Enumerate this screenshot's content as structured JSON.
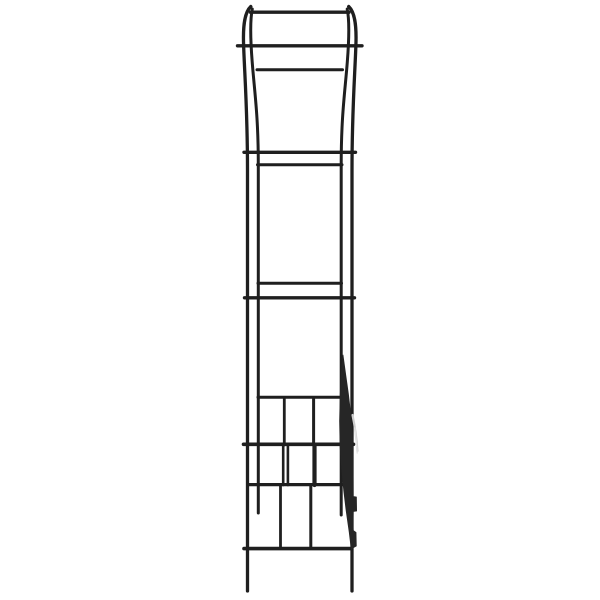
{
  "figure": {
    "alt": "Black metal garden arch trellis, side view, on white background",
    "background": "#ffffff",
    "metal_color": "#1f1f1f",
    "canvas": {
      "width": 600,
      "height": 600
    },
    "tubes": [
      {
        "name": "left-outer-tube",
        "d": "M 250.8,6.5 C 245,12 242.8,24 243.6,45 C 244.6,75 247.5,110 247.5,170 L 247.5,591",
        "w": 3.3
      },
      {
        "name": "left-inner-tube",
        "d": "M 252.3,9 C 250,20 250.3,38 252.2,62 C 254.5,92 258.3,115 258.3,165 L 258.3,513",
        "w": 3.0
      },
      {
        "name": "right-outer-tube",
        "d": "M 348.7,6.5 C 354.5,12 356.7,24 355.9,45 C 354.9,75 352,110 352,170 L 352,591",
        "w": 3.3
      },
      {
        "name": "right-inner-tube",
        "d": "M 347.2,9 C 349.5,20 349.2,38 347.3,62 C 345,92 341.2,115 341.2,165 L 341.2,515",
        "w": 3.0
      }
    ],
    "crossbars": [
      {
        "name": "top-arch-bar",
        "y": 12.2,
        "x1": 250.5,
        "x2": 349.0,
        "w": 3.4
      },
      {
        "name": "crossbar-2",
        "y": 45.8,
        "x1": 237.5,
        "x2": 362.0,
        "w": 3.4
      },
      {
        "name": "crossbar-3",
        "y": 69.8,
        "x1": 257.0,
        "x2": 342.5,
        "w": 3.0
      },
      {
        "name": "crossbar-4",
        "y": 152.3,
        "x1": 244.0,
        "x2": 355.5,
        "w": 3.4
      },
      {
        "name": "crossbar-5",
        "y": 164.8,
        "x1": 257.5,
        "x2": 342.0,
        "w": 3.0
      },
      {
        "name": "crossbar-6",
        "y": 283.2,
        "x1": 258.0,
        "x2": 341.5,
        "w": 3.0
      },
      {
        "name": "crossbar-7",
        "y": 297.8,
        "x1": 244.5,
        "x2": 354.5,
        "w": 3.4
      },
      {
        "name": "crossbar-8",
        "y": 397.3,
        "x1": 258.0,
        "x2": 342.5,
        "w": 3.0
      },
      {
        "name": "crossbar-9",
        "y": 444.3,
        "x1": 243.5,
        "x2": 353.5,
        "w": 3.6
      },
      {
        "name": "crossbar-10",
        "y": 484.6,
        "x1": 249.0,
        "x2": 345.0,
        "w": 3.2
      },
      {
        "name": "bottom-crossbar",
        "y": 548.6,
        "x1": 244.0,
        "x2": 351.5,
        "w": 3.6
      }
    ],
    "lattice_rods": [
      {
        "name": "lattice-rod-1",
        "x": 284.3,
        "y1": 399,
        "y2": 445,
        "w": 2.8
      },
      {
        "name": "lattice-rod-2",
        "x": 313.6,
        "y1": 399,
        "y2": 445,
        "w": 3.0
      },
      {
        "name": "lattice-rod-3",
        "x": 283.2,
        "y1": 445,
        "y2": 485,
        "w": 2.6
      },
      {
        "name": "lattice-rod-4",
        "x": 287.9,
        "y1": 445,
        "y2": 485,
        "w": 2.6
      },
      {
        "name": "lattice-rod-5",
        "x": 314.5,
        "y1": 445,
        "y2": 485,
        "w": 4.2
      },
      {
        "name": "lattice-rod-6",
        "x": 280.5,
        "y1": 485,
        "y2": 547,
        "w": 2.8
      },
      {
        "name": "lattice-rod-7",
        "x": 310.8,
        "y1": 485,
        "y2": 547,
        "w": 3.0
      }
    ],
    "trellis_blade": {
      "fill": "#262626",
      "points": "343,355 345.6,374 348.4,394 350.7,414 352.2,434 352.9,454 353.1,476 353.2,496.5 356.4,497 356.6,511 353.2,511.5 353,524 353.2,530.5 356,532.5 356.3,546 352.6,548 351.3,549.5 349.2,532 346.2,511 343.8,491 341.6,468 340.1,446 339.6,421 340.2,396 341.3,373"
    },
    "highlights": [
      {
        "name": "blade-highlight-1",
        "d": "M 352.5,415 C 354.6,425 356.6,438 357.4,451",
        "w": 2.2,
        "color": "#cfcfcf"
      },
      {
        "name": "blade-highlight-2",
        "d": "M 354.8,428 C 355.8,436 356.8,446 357.2,453",
        "w": 1.4,
        "color": "#e6e6e6"
      }
    ]
  }
}
